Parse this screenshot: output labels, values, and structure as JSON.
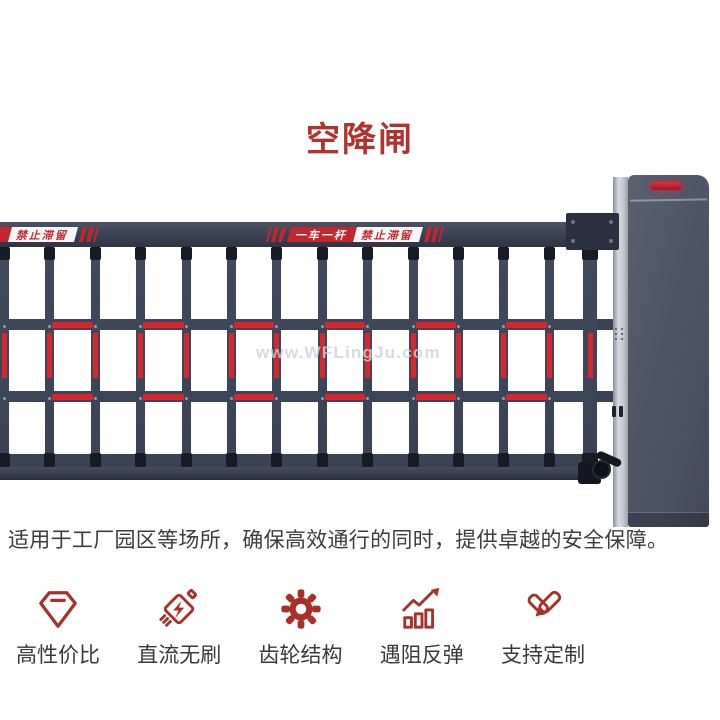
{
  "header": {
    "title": "空降闸"
  },
  "product": {
    "watermark": "www.WFLingJu.com",
    "boom_decals": {
      "sign_red_text": "一车一杆",
      "sign_white_text": "禁止滞留"
    }
  },
  "description": {
    "text": "适用于工厂园区等场所，确保高效通行的同时，提供卓越的安全保障。"
  },
  "features": [
    {
      "icon": "gem-icon",
      "label": "高性价比"
    },
    {
      "icon": "motor-icon",
      "label": "直流无刷"
    },
    {
      "icon": "gear-icon",
      "label": "齿轮结构"
    },
    {
      "icon": "rebound-chart-icon",
      "label": "遇阻反弹"
    },
    {
      "icon": "pen-icon",
      "label": "支持定制"
    }
  ],
  "colors": {
    "title_red": "#b23230",
    "icon_red": "#a93028",
    "strip_red": "#d62730",
    "sign_red": "#c5262e",
    "led_red": "#c2202e",
    "frame_dark": "#3a4254",
    "cabinet_gray": "#4d5566",
    "text_dark": "#3d3d3d"
  }
}
